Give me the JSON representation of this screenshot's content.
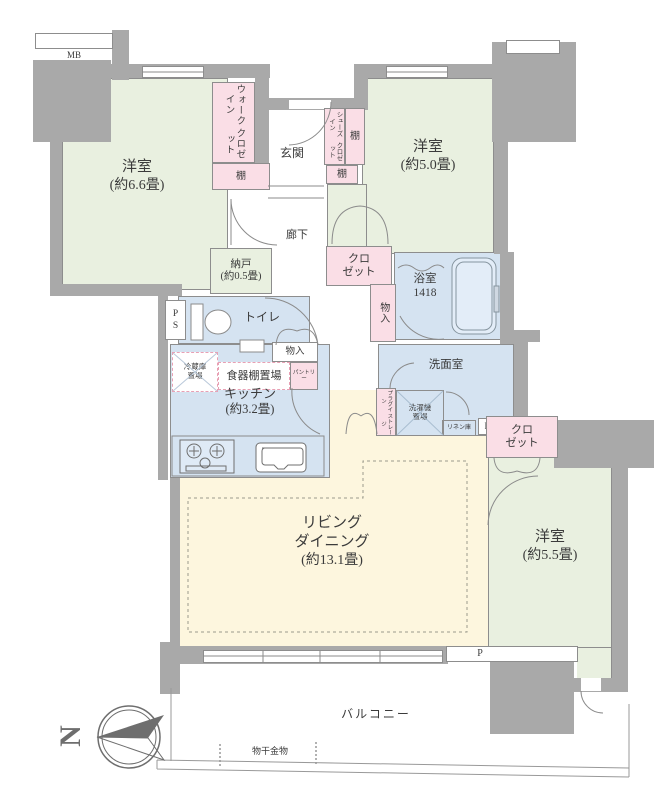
{
  "rooms": {
    "bedroom_66": {
      "name": "洋室",
      "size": "(約6.6畳)"
    },
    "bedroom_50": {
      "name": "洋室",
      "size": "(約5.0畳)"
    },
    "bedroom_55": {
      "name": "洋室",
      "size": "(約5.5畳)"
    },
    "living": {
      "name_line1": "リビング",
      "name_line2": "ダイニング",
      "size": "(約13.1畳)"
    },
    "kitchen": {
      "name": "キッチン",
      "size": "(約3.2畳)"
    },
    "storeroom": {
      "name": "納戸",
      "size": "(約0.5畳)"
    },
    "bathroom": {
      "name": "浴室",
      "size": "1418"
    },
    "washroom": {
      "name": "洗面室"
    },
    "toilet": {
      "name": "トイレ"
    },
    "entrance": {
      "name": "玄関"
    },
    "hallway": {
      "name": "廊下"
    },
    "balcony": {
      "name": "バルコニー"
    }
  },
  "storage": {
    "walk_in_closet": {
      "line1": "ウォークイン",
      "line2": "クロゼット"
    },
    "shoes_in_closet": {
      "line1": "シューズイン",
      "line2": "クロゼット"
    },
    "shelf": "棚",
    "closet": {
      "line1": "クロ",
      "line2": "ゼット"
    },
    "storage_small": "物入",
    "refrigerator_space": {
      "line1": "冷蔵庫",
      "line2": "置場"
    },
    "cupboard_space": "食器棚置場",
    "pantry": "パントリー",
    "washer_space": {
      "line1": "洗濯機",
      "line2": "置場"
    },
    "linen_cabinet": "リネン庫",
    "plugin_storage": {
      "line1": "プラグイン",
      "line2": "ストレージ"
    }
  },
  "labels": {
    "meter_box": "MB",
    "pipe_space_v1": "P",
    "pipe_space_v2": "S",
    "pipe_space": "PS",
    "pillar": "P",
    "laundry_hanger": "物干金物",
    "north": "N"
  },
  "colors": {
    "wall": "#a9a9a9",
    "room_green": "#e9f0e0",
    "closet_pink": "#fadee6",
    "water_blue": "#d5e3f1",
    "living_cream": "#fdf6de"
  }
}
